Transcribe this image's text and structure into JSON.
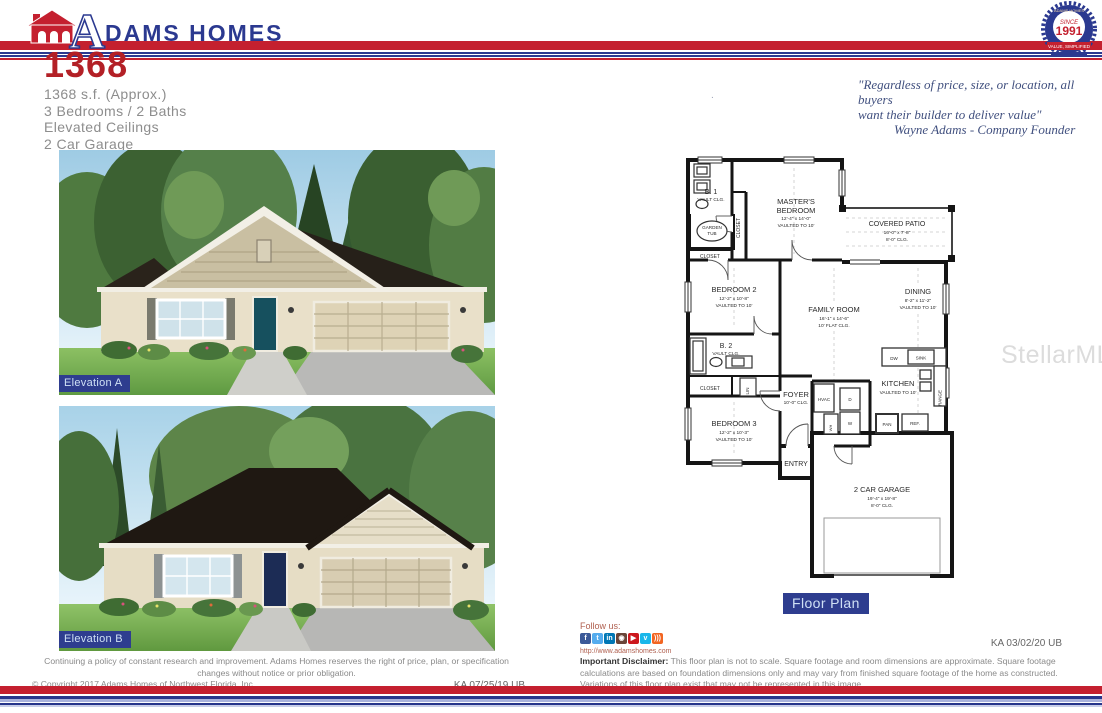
{
  "header": {
    "brand_a": "A",
    "brand_rest": "DAMS HOMES",
    "badge": {
      "since": "SINCE",
      "year": "1991",
      "banner": "VALUE, SIMPLIFIED",
      "arc": "ADAMS HOMES"
    }
  },
  "title": {
    "model": "1368",
    "spec1": "1368 s.f. (Approx.)",
    "spec2": "3 Bedrooms / 2 Baths",
    "spec3": "Elevated Ceilings",
    "spec4": "2 Car Garage"
  },
  "quote": {
    "line1": "\"Regardless of price, size, or location, all buyers",
    "line2": "want their builder to deliver value\"",
    "line3": "Wayne Adams - Company Founder",
    "stray_mark": "."
  },
  "elevations": {
    "a_label": "Elevation A",
    "b_label": "Elevation B"
  },
  "floorplan": {
    "label": "Floor Plan",
    "b1_name": "B. 1",
    "b1_clg": "VAULT CLG.",
    "garden1": "GARDEN",
    "garden2": "TUB",
    "closet_master": "CLOSET",
    "closet_hall": "CLOSET",
    "master1": "MASTER'S",
    "master2": "BEDROOM",
    "master_d": "12'-4\" x 14'-0\"",
    "master_c": "VAULTED TO 10'",
    "patio_n": "COVERED PATIO",
    "patio_d": "16'-0\" x 7'-8\"",
    "patio_c": "8'-0\" CLG.",
    "bed2_n": "BEDROOM 2",
    "bed2_d": "12'-2\" x 10'-8\"",
    "bed2_c": "VAULTED TO 10'",
    "family_n": "FAMILY ROOM",
    "family_d": "16'-1\" x 14'-6\"",
    "family_c": "10' FLAT CLG.",
    "dining_n": "DINING",
    "dining_d": "8'-2\" x 11'-2\"",
    "dining_c": "VAULTED TO 10'",
    "b2_name": "B. 2",
    "b2_clg": "VAULT CLG.",
    "closet_bed3": "CLOSET",
    "lin": "LIN",
    "bed3_n": "BEDROOM 3",
    "bed3_d": "12'-2\" x 10'-3\"",
    "bed3_c": "VAULTED TO 10'",
    "foyer_n": "FOYER",
    "foyer_c": "10'-0\" CLG.",
    "hvac": "HVAC",
    "dryer": "D",
    "washer": "W",
    "wh": "WH",
    "entry": "ENTRY",
    "kitchen_n": "KITCHEN",
    "kitchen_c": "VAULTED TO 10'",
    "dw": "DW",
    "sink": "SINK",
    "range": "RANGE",
    "pan": "PAN",
    "ref": "REF.",
    "garage_n": "2 CAR GARAGE",
    "garage_d": "19'-4\" x 19'-8\"",
    "garage_c": "8'-0\" CLG."
  },
  "watermark": "StellarMLS",
  "footer": {
    "follow": "Follow us:",
    "url": "http://www.adamshomes.com",
    "social": [
      {
        "glyph": "f",
        "style": "background:#3b5998"
      },
      {
        "glyph": "t",
        "style": "background:#55acee"
      },
      {
        "glyph": "in",
        "style": "background:#0077b5"
      },
      {
        "glyph": "◉",
        "style": "background:#6a4539"
      },
      {
        "glyph": "▶",
        "style": "background:#cc181e"
      },
      {
        "glyph": "v",
        "style": "background:#1ab7ea"
      },
      {
        "glyph": ")))",
        "style": "background:#f26522"
      }
    ],
    "right_code": "KA 03/02/20 UB",
    "disclaimer_bold": "Important Disclaimer:",
    "disclaimer_rest": " This floor plan is not to scale. Square footage and room dimensions are approximate. Square footage calculations are based on foundation dimensions only and may vary from finished square footage of the home as constructed. Variations of this floor plan exist that may not be represented in this image.",
    "left_line1": "Continuing a policy of constant research and improvement. Adams Homes reserves the right of price, plan, or specification changes without notice or prior obligation.",
    "left_line2": "© Copyright 2017   Adams Homes of Northwest Florida, Inc.",
    "left_code": "KA 07/25/19 UB"
  },
  "colors": {
    "brand_red": "#c4202f",
    "brand_blue": "#2b3990",
    "title_red": "#b32026"
  }
}
